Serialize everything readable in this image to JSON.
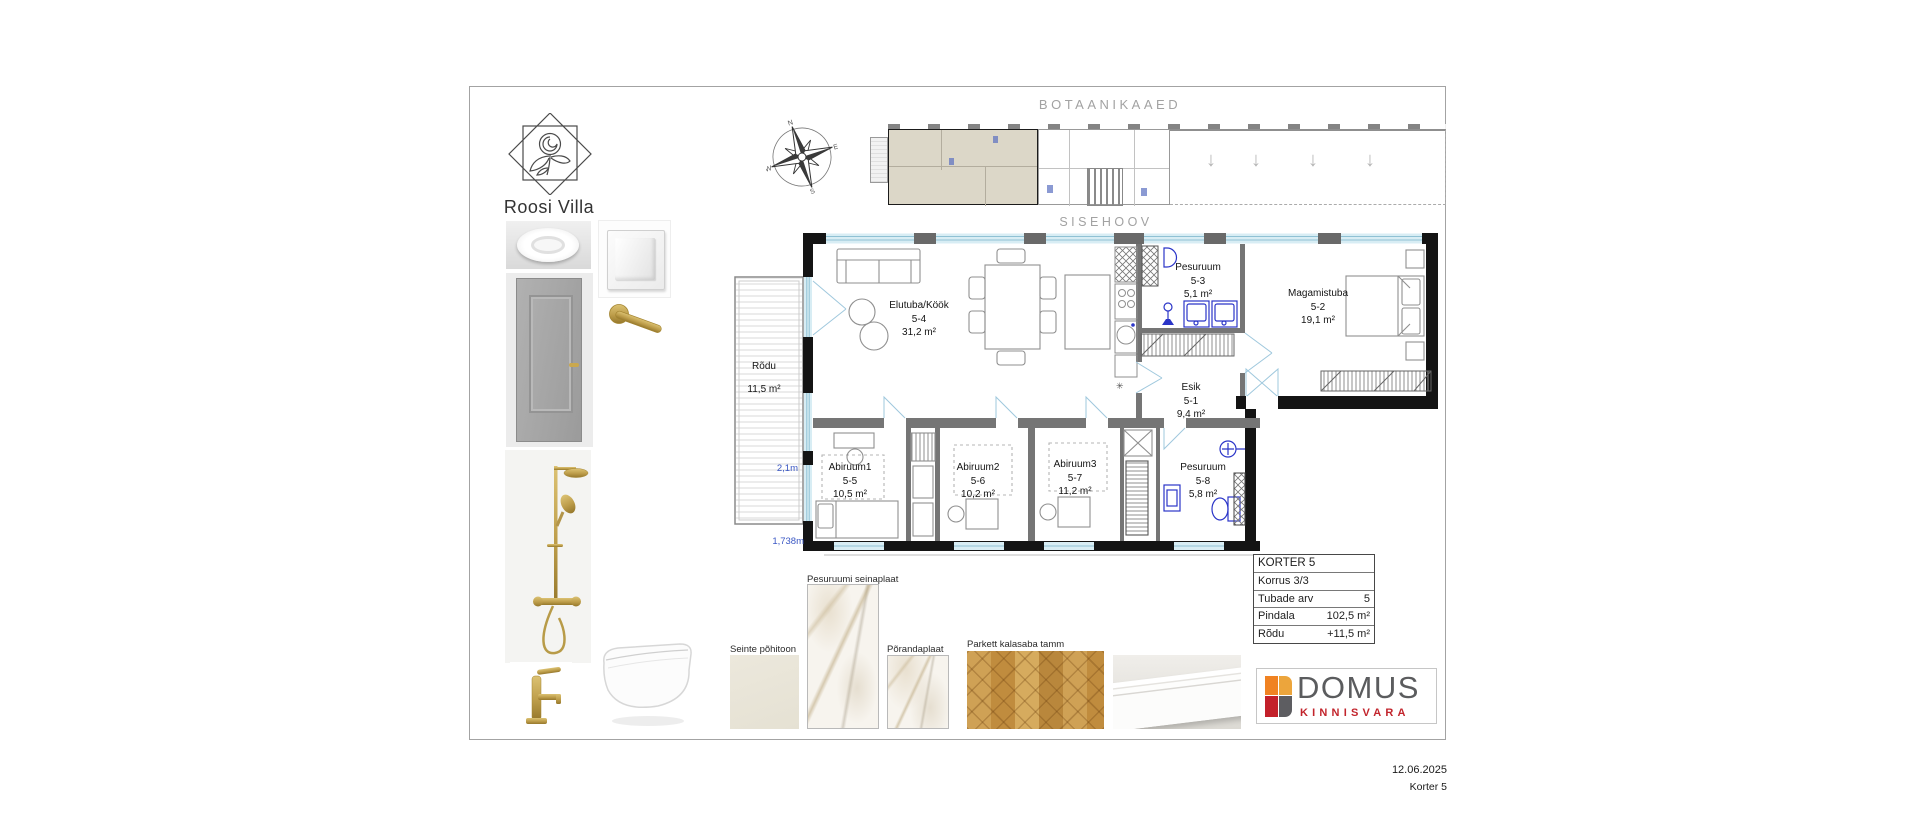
{
  "sheet": {
    "brand": {
      "title": "Roosi Villa"
    },
    "context": {
      "garden_label": "BOTAANIKAAED",
      "courtyard_label": "SISEHOOV"
    },
    "compass": {
      "n": "N",
      "e": "E",
      "s": "S",
      "w": "W"
    },
    "plan": {
      "balcony": {
        "name": "Rõdu",
        "area": "11,5 m²"
      },
      "dimensions": {
        "width": "2,1m",
        "depth": "1,738m"
      },
      "rooms": [
        {
          "name": "Elutuba/Köök",
          "no": "5-4",
          "area": "31,2 m²"
        },
        {
          "name": "Pesuruum",
          "no": "5-3",
          "area": "5,1 m²"
        },
        {
          "name": "Magamistuba",
          "no": "5-2",
          "area": "19,1 m²"
        },
        {
          "name": "Esik",
          "no": "5-1",
          "area": "9,4 m²"
        },
        {
          "name": "Abiruum1",
          "no": "5-5",
          "area": "10,5 m²"
        },
        {
          "name": "Abiruum2",
          "no": "5-6",
          "area": "10,2 m²"
        },
        {
          "name": "Abiruum3",
          "no": "5-7",
          "area": "11,2 m²"
        },
        {
          "name": "Pesuruum",
          "no": "5-8",
          "area": "5,8 m²"
        }
      ],
      "icons": {
        "kitchen_symbol": "✳",
        "terrace_arrow": "↓"
      }
    },
    "info_table": {
      "title": "KORTER 5",
      "rows": [
        {
          "label": "Korrus 3/3",
          "value": ""
        },
        {
          "label": "Tubade arv",
          "value": "5"
        },
        {
          "label": "Pindala",
          "value": "102,5 m²"
        },
        {
          "label": "Rõdu",
          "value": "+11,5 m²"
        }
      ]
    },
    "materials": {
      "wall_tone": {
        "label": "Seinte põhitoon"
      },
      "bathroom_tile": {
        "label": "Pesuruumi seinaplaat"
      },
      "floor_tile": {
        "label": "Põrandaplaat"
      },
      "parquet": {
        "label": "Parkett kalasaba tamm"
      }
    },
    "agency": {
      "name": "DOMUS",
      "tagline": "KINNISVARA"
    },
    "colors": {
      "accent_blue": "#2b35c8",
      "window_glass": "#d8edf4",
      "highlight_beige": "#dcd7c8",
      "gold": "#bfa04a",
      "logo_orange": "#f08222",
      "logo_amber": "#eca53c",
      "logo_red": "#c3202a",
      "logo_grey": "#5d5d61",
      "brand_red": "#c2242c"
    }
  },
  "footer": {
    "date": "12.06.2025",
    "sheet_name": "Korter 5"
  }
}
